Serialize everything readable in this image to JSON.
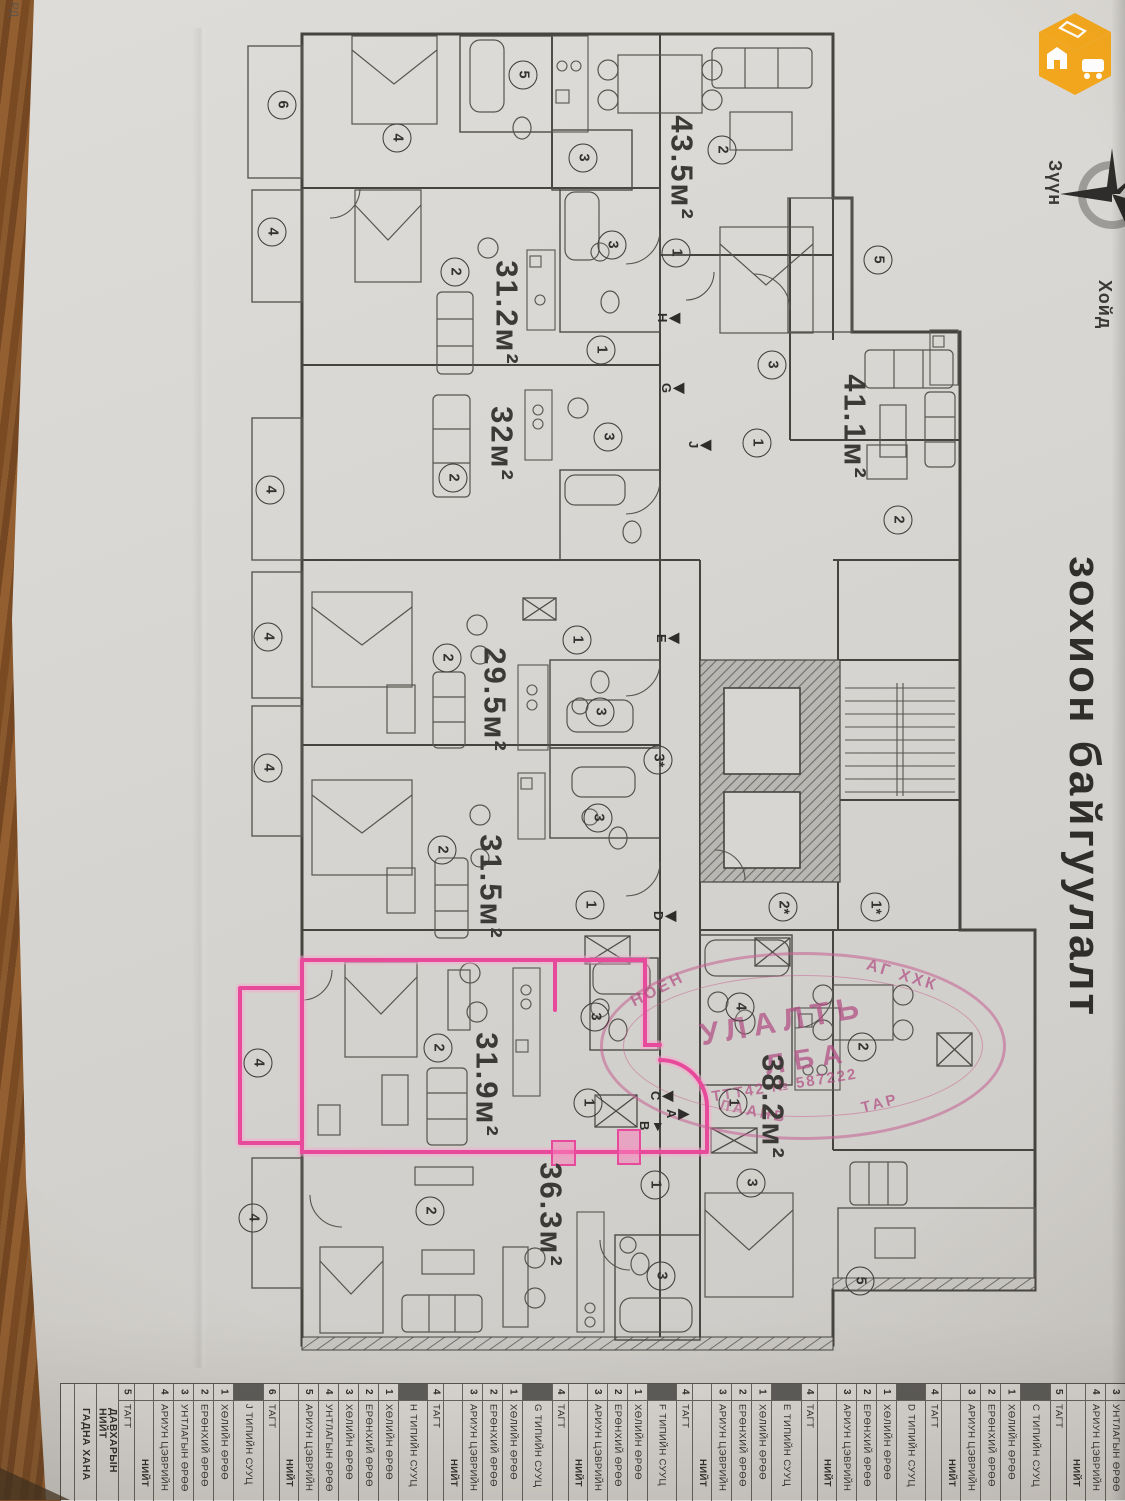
{
  "page": {
    "title_vertical": "зохион байгуулалт",
    "corner_fragment": "РД"
  },
  "compass": {
    "east": "Зүүн",
    "north": "Хойд"
  },
  "logo": {
    "color": "#f3a71d",
    "faces": [
      "house",
      "car",
      "phone"
    ]
  },
  "highlight": {
    "unit_area": "31.9м²",
    "color": "#e84a9b"
  },
  "stamp": {
    "color": "#c2608f",
    "arc_top_left": "НОЕН",
    "arc_top_right": "АГ ХХК",
    "line_large_1": "УЛАЛТЬ",
    "line_large_2": "ЛБА",
    "line_reg": "ТТТ42 № 587222",
    "arc_bottom_left": "ЛААНБ",
    "arc_bottom_right": "ТАР"
  },
  "plan": {
    "area_labels": [
      "43.5м²",
      "31.2м²",
      "32м²",
      "41.1м²",
      "29.5м²",
      "31.5м²",
      "31.9м²",
      "38.2м²",
      "36.3м²"
    ],
    "room_marks": [
      "6",
      "4",
      "5",
      "3",
      "2",
      "4",
      "2",
      "3",
      "1",
      "1",
      "5",
      "3",
      "1",
      "2",
      "4",
      "2",
      "3",
      "4",
      "2",
      "1",
      "3",
      "4",
      "2",
      "3",
      "1",
      "2*",
      "1*",
      "3*",
      "4",
      "2",
      "3",
      "1",
      "4",
      "1",
      "2",
      "4",
      "2",
      "1",
      "3",
      "3",
      "5"
    ],
    "section_markers": [
      "Н",
      "G",
      "J",
      "Е",
      "D",
      "С",
      "А",
      "В"
    ]
  },
  "table": {
    "columns": [
      {
        "k": "b",
        "n": "",
        "t": ""
      },
      {
        "k": "f",
        "n": "",
        "t": "ГАДНА ХАНА"
      },
      {
        "k": "f",
        "n": "",
        "t": "ДАВХАРЫН НИЙТ"
      },
      {
        "k": "r",
        "n": "5",
        "t": "ТАГТ"
      },
      {
        "k": "t",
        "n": "",
        "t": "НИЙТ"
      },
      {
        "k": "r",
        "n": "4",
        "t": "АРИУН ЦЭВРИЙН"
      },
      {
        "k": "r",
        "n": "3",
        "t": "УНТЛАГЫН ӨРӨӨ"
      },
      {
        "k": "r",
        "n": "2",
        "t": "ЕРӨНХИЙ ӨРӨӨ"
      },
      {
        "k": "r",
        "n": "1",
        "t": "ХӨЛИЙН ӨРӨӨ"
      },
      {
        "k": "h",
        "n": "",
        "t": "J ТИПИЙН СУУЦ"
      },
      {
        "k": "r",
        "n": "6",
        "t": "ТАГТ"
      },
      {
        "k": "t",
        "n": "",
        "t": "НИЙТ"
      },
      {
        "k": "r",
        "n": "5",
        "t": "АРИУН ЦЭВРИЙН"
      },
      {
        "k": "r",
        "n": "4",
        "t": "УНТЛАГЫН ӨРӨӨ"
      },
      {
        "k": "r",
        "n": "3",
        "t": "ХӨЛИЙН ӨРӨӨ"
      },
      {
        "k": "r",
        "n": "2",
        "t": "ЕРӨНХИЙ ӨРӨӨ"
      },
      {
        "k": "r",
        "n": "1",
        "t": "ХӨЛИЙН ӨРӨӨ"
      },
      {
        "k": "h",
        "n": "",
        "t": "Н ТИПИЙН СУУЦ"
      },
      {
        "k": "r",
        "n": "4",
        "t": "ТАГТ"
      },
      {
        "k": "t",
        "n": "",
        "t": "НИЙТ"
      },
      {
        "k": "r",
        "n": "3",
        "t": "АРИУН ЦЭВРИЙН"
      },
      {
        "k": "r",
        "n": "2",
        "t": "ЕРӨНХИЙ ӨРӨӨ"
      },
      {
        "k": "r",
        "n": "1",
        "t": "ХӨЛИЙН ӨРӨӨ"
      },
      {
        "k": "h",
        "n": "",
        "t": "G ТИПИЙН СУУЦ"
      },
      {
        "k": "r",
        "n": "4",
        "t": "ТАГТ"
      },
      {
        "k": "t",
        "n": "",
        "t": "НИЙТ"
      },
      {
        "k": "r",
        "n": "3",
        "t": "АРИУН ЦЭВРИЙН"
      },
      {
        "k": "r",
        "n": "2",
        "t": "ЕРӨНХИЙ ӨРӨӨ"
      },
      {
        "k": "r",
        "n": "1",
        "t": "ХӨЛИЙН ӨРӨӨ"
      },
      {
        "k": "h",
        "n": "",
        "t": "F ТИПИЙН СУУЦ"
      },
      {
        "k": "r",
        "n": "4",
        "t": "ТАГТ"
      },
      {
        "k": "t",
        "n": "",
        "t": "НИЙТ"
      },
      {
        "k": "r",
        "n": "3",
        "t": "АРИУН ЦЭВРИЙН"
      },
      {
        "k": "r",
        "n": "2",
        "t": "ЕРӨНХИЙ ӨРӨӨ"
      },
      {
        "k": "r",
        "n": "1",
        "t": "ХӨЛИЙН ӨРӨӨ"
      },
      {
        "k": "h",
        "n": "",
        "t": "Е ТИПИЙН СУУЦ"
      },
      {
        "k": "r",
        "n": "4",
        "t": "ТАГТ"
      },
      {
        "k": "t",
        "n": "",
        "t": "НИЙТ"
      },
      {
        "k": "r",
        "n": "3",
        "t": "АРИУН ЦЭВРИЙН"
      },
      {
        "k": "r",
        "n": "2",
        "t": "ЕРӨНХИЙ ӨРӨӨ"
      },
      {
        "k": "r",
        "n": "1",
        "t": "ХӨЛИЙН ӨРӨӨ"
      },
      {
        "k": "h",
        "n": "",
        "t": "D ТИПИЙН СУУЦ"
      },
      {
        "k": "r",
        "n": "4",
        "t": "ТАГТ"
      },
      {
        "k": "t",
        "n": "",
        "t": "НИЙТ"
      },
      {
        "k": "r",
        "n": "3",
        "t": "АРИУН ЦЭВРИЙН"
      },
      {
        "k": "r",
        "n": "2",
        "t": "ЕРӨНХИЙ ӨРӨӨ"
      },
      {
        "k": "r",
        "n": "1",
        "t": "ХӨЛИЙН ӨРӨӨ"
      },
      {
        "k": "h",
        "n": "",
        "t": "С ТИПИЙН СУУЦ"
      },
      {
        "k": "r",
        "n": "5",
        "t": "ТАГТ"
      },
      {
        "k": "t",
        "n": "",
        "t": "НИЙТ"
      },
      {
        "k": "r",
        "n": "4",
        "t": "АРИУН ЦЭВРИЙН"
      },
      {
        "k": "r",
        "n": "3",
        "t": "УНТЛАГЫН ӨРӨӨ"
      },
      {
        "k": "r",
        "n": "2",
        "t": "ЕРӨНХИЙ ӨРӨӨ"
      },
      {
        "k": "r",
        "n": "1",
        "t": "ХӨЛИЙН ӨРӨӨ"
      },
      {
        "k": "h",
        "n": "",
        "t": "В ТИПИЙН СУУЦ"
      },
      {
        "k": "r",
        "n": "5",
        "t": "ТАГТ"
      },
      {
        "k": "t",
        "n": "",
        "t": "НИЙТ"
      },
      {
        "k": "r",
        "n": "4",
        "t": "АРИУН ЦЭВРИЙН"
      },
      {
        "k": "r",
        "n": "3",
        "t": "УНТЛАГЫН ӨРӨӨ"
      },
      {
        "k": "r",
        "n": "2",
        "t": "ЕРӨНХИЙ ӨРӨӨ"
      },
      {
        "k": "r",
        "n": "1",
        "t": "ХӨЛИЙН ӨРӨӨ"
      },
      {
        "k": "h",
        "n": "",
        "t": "А ТИПИЙН СУУЦ"
      },
      {
        "k": "s",
        "n": "3*",
        "t": "ЕРӨНХИЙ ХОНГИЛ"
      },
      {
        "k": "s",
        "n": "2*",
        "t": "ГОНХ"
      },
      {
        "k": "s",
        "n": "1*",
        "t": "ЕРӨНХИЙ ТАГТ"
      }
    ]
  }
}
